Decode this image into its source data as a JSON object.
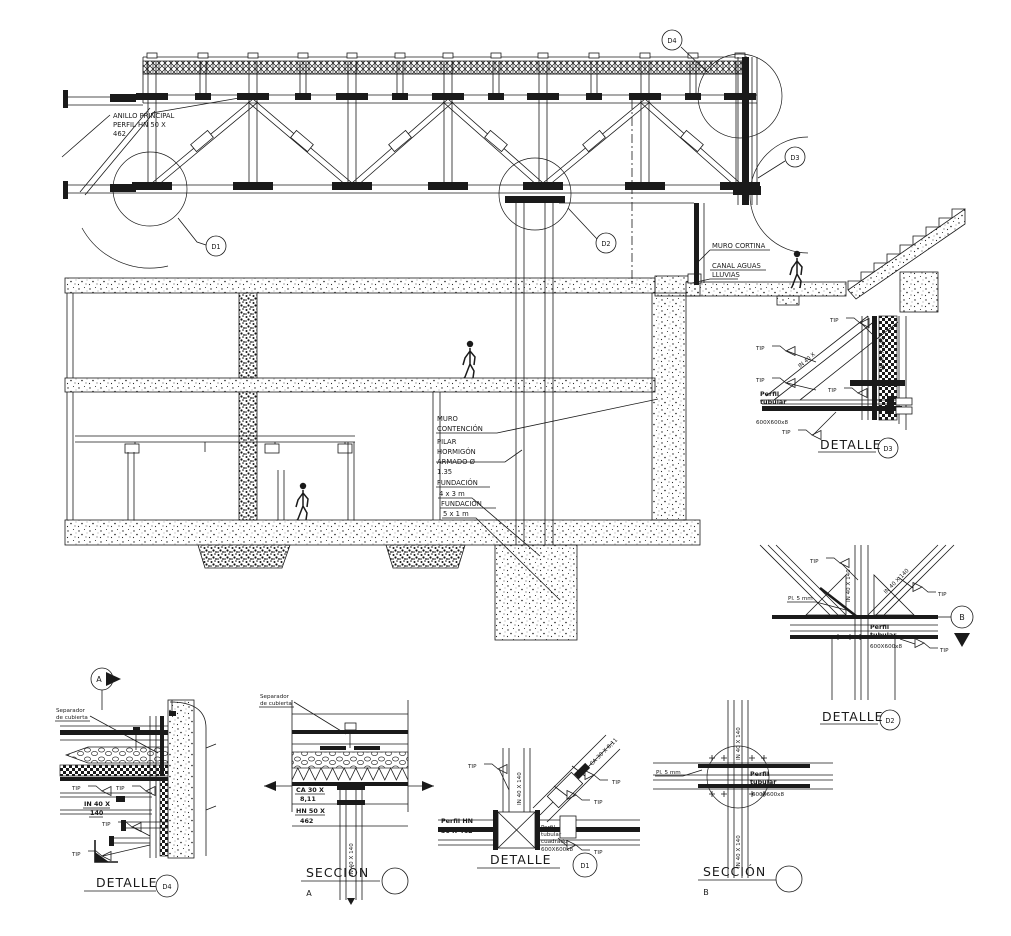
{
  "main": {
    "anillo": [
      "ANILLO PRINCIPAL",
      "PERFIL HN 50 X",
      "462"
    ],
    "muro_cortina": "MURO CORTINA",
    "canal_aguas": [
      "CANAL AGUAS",
      "LLUVIAS"
    ],
    "muro_contencion": [
      "MURO",
      "CONTENCIÓN"
    ],
    "pilar": [
      "PILAR",
      "HORMIGÓN",
      "ARMADO Ø",
      "1.35"
    ],
    "fundacion_4x3": [
      "FUNDACIÓN",
      "4 x 3 m"
    ],
    "fundacion_5x1": [
      "FUNDACIÓN",
      "5 x 1 m"
    ],
    "markers": {
      "d1": "D1",
      "d2": "D2",
      "d3": "D3",
      "d4": "D4"
    }
  },
  "common": {
    "tip": "TIP",
    "in40x140": "IN 40 X 140",
    "in40x": "IN 40 X",
    "n140": "140",
    "detalle": "DETALLE",
    "seccion": "SECCIÓN",
    "perfil": "Perfil",
    "tubular": "tubular",
    "size600": "600X600x8",
    "pl5": "Pl. 5 mm"
  },
  "details": {
    "d3": {
      "marker": "D3"
    },
    "d2": {
      "marker": "D2",
      "section_ref": "B"
    },
    "d4": {
      "marker": "D4",
      "separador": [
        "Separador",
        "de cubierta"
      ],
      "section_ref": "A"
    },
    "sa": {
      "letter": "A",
      "separador": [
        "Separador",
        "de cubierta"
      ],
      "ca30": [
        "CA 30 X",
        "8,11"
      ],
      "hn50": [
        "HN 50 X",
        "462"
      ]
    },
    "d1": {
      "marker": "D1",
      "perfil_hn": [
        "Perfil HN",
        "50 X 462"
      ],
      "tubular4": [
        "Perfil",
        "tubular",
        "cuadrado",
        "600X600x8"
      ],
      "ca30_diag": "CA 30 X 8,11"
    },
    "sb": {
      "letter": "B"
    }
  }
}
